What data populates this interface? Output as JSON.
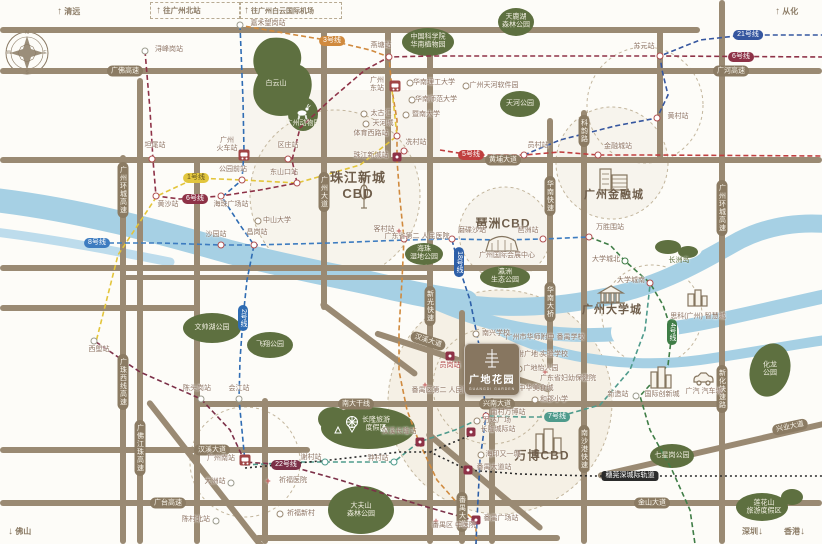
{
  "icons": {
    "up": "↑",
    "down": "↓",
    "hospital": "+"
  },
  "compass": {
    "n": "N",
    "e": "E",
    "s": "S",
    "w": "W"
  },
  "edges": {
    "qingyuan": "清远",
    "gzbei": "往广州北站",
    "airport": "往广州白云国际机场",
    "conghua": "从化",
    "foshan": "佛山",
    "shenzhen": "深圳",
    "hongkong": "香港"
  },
  "cbd": {
    "zhujiang": "珠江新城\nCBD",
    "pazhou": "琶洲CBD",
    "financial": "广州金融城",
    "university": "广州大学城",
    "wanbo": "万博CBD"
  },
  "project": {
    "name": "广地花园",
    "subtitle": "GUANGDI GARDEN"
  },
  "roads": {
    "guangfo_expwy": "广佛高速",
    "guanghe_expwy": "广河高速",
    "huangpu_ave": "黄埔大道",
    "gz_ring_expwy": "广州环城高速",
    "guangzhu_w_expwy": "广珠西线高速",
    "gfjz_expwy": "广佛江珠高速",
    "gz_ave": "广州大道",
    "huanan_expwy": "华南快速",
    "huanan_bridge": "华南大桥",
    "keyun_rd": "科韵路",
    "nansha_port_expwy": "南沙港快速",
    "xinhua_expwy": "新化快速路",
    "xinguang_expwy": "新光快速",
    "panyu_ave": "番禺大道",
    "hanxi_ave": "汉溪大道",
    "guangtai_expwy": "广台高速",
    "jinshan_ave": "金山大道",
    "xingnan_ave": "兴南大道",
    "nanda_trunk": "南大干线",
    "xingye_ave": "兴业大道"
  },
  "badges": {
    "l1": "1号线",
    "l2": "2号线",
    "l3": "3号线",
    "l4": "4号线",
    "l5": "5号线",
    "l6": "6号线",
    "l7": "7号线",
    "l8": "8号线",
    "l18": "18号线",
    "l21": "21号线",
    "l22": "22号线",
    "intercity": "穗莞深城际轨道"
  },
  "stations": {
    "jiahewanggang": "嘉禾望岗站",
    "xunfenggang": "浔峰岗站",
    "yantang": "燕塘站",
    "suyuan": "苏元站",
    "huangcun": "黄村站",
    "yuancun": "员村站",
    "jinrongcheng": "金融城站",
    "tanwei": "坦尾站",
    "quzhuang": "区庄站",
    "gongyuanqian": "公园前站",
    "dongshankou": "东山口站",
    "huangsha": "黄沙站",
    "haizhu_sq": "海珠广场站",
    "tiyuxilu": "体育西路站",
    "zhujiangxincheng": "珠江新城站",
    "xiancun": "冼村站",
    "kecun": "客村站",
    "modiesha": "磨碟沙站",
    "pazhou": "琶洲站",
    "wanshengwei": "万胜围站",
    "uc_north": "大学城北",
    "uc_south": "大学城南",
    "xinzao": "新造站",
    "shayuan": "沙园站",
    "changgang": "昌岗站",
    "xilang": "西塱站",
    "chentougang": "陈头岗站",
    "huijiang": "会江站",
    "dazhou": "大洲站",
    "chencunbei": "陈村北站",
    "xiecun": "谢村站",
    "zhongcun": "钟村站",
    "hanxichanglong": "汉溪长隆站",
    "nancunwanbo": "南村万博站",
    "yuangang": "员岗站",
    "panyu_ave_st": "番禺大道站",
    "panyu_sq": "番禺广场站",
    "gz_south": "广州南站",
    "gz_railway": "广州\n火车站",
    "gz_east": "广州\n东站",
    "changlong_ic": "长隆城际站"
  },
  "parks": {
    "baiyun": "白云山",
    "botanical": "中国科学院\n华南植物园",
    "tianluhu": "天鹿湖\n森林公园",
    "tianhe": "天河公园",
    "zoo": "广州动物园",
    "haizhu_wet": "海珠\n湿地公园",
    "yingzhou": "瀛洲\n生态公园",
    "changzhou": "长洲岛",
    "wenshuaihu": "文帅湖公园",
    "feixiang": "飞翔公园",
    "changlong": "长隆旅游\n度假区",
    "dafushan": "大夫山\n森林公园",
    "qixinggang": "七星岗公园",
    "lianhuashan": "莲花山\n旅游度假区",
    "hualong": "化龙\n公园"
  },
  "pois": {
    "taikoo": "太古汇",
    "teemall": "天河城",
    "scut": "华南理工大学",
    "scnu": "华南师范大学",
    "jinan": "暨南大学",
    "software": "广州天河软件园",
    "sysu": "中山大学",
    "gd2_hosp": "广东省第二\n人民医院",
    "canton_fair": "广州国际会展中心",
    "cisco": "思科(广州)\n智慧城",
    "innov": "国际创新城",
    "gac": "广汽\n汽车城",
    "wanda": "万达广场",
    "haiyin": "海印又一城",
    "food_city": "中华美食城",
    "gd_women": "广东省妇幼保健院",
    "py_tcm": "番禺区\n中医院",
    "qifu_hosp": "祈福医院",
    "qifu_vil": "祈福新村",
    "hsfz": "广州市华师附中\n番禺学校",
    "hf_guangdi": "华附广地\n实验学校",
    "yiren": "广地怡人园",
    "nanxing": "南兴学校",
    "hejun": "和郡小学",
    "py2_hosp": "番禺区第二\n人民医院"
  }
}
